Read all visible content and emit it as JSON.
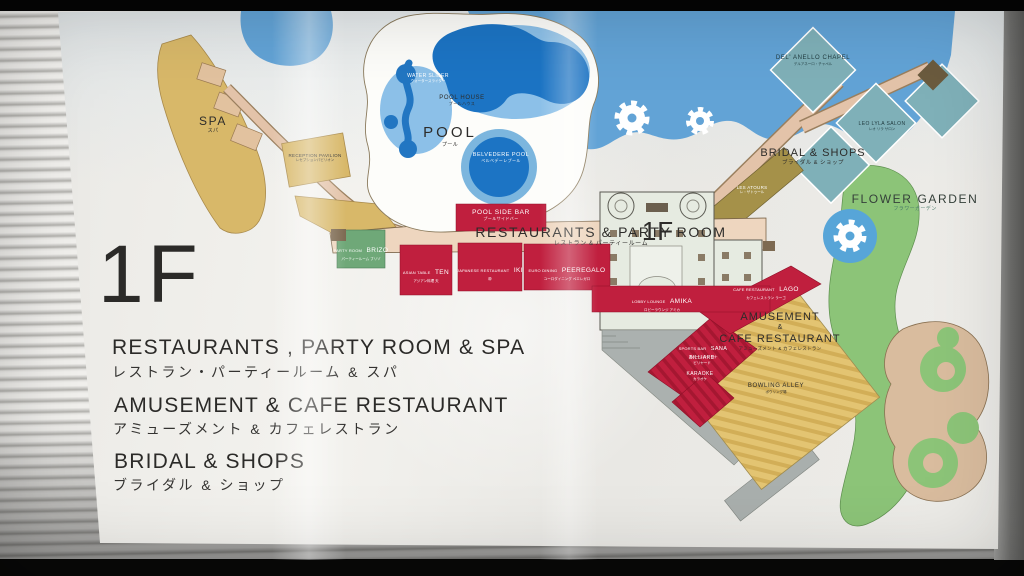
{
  "sign": {
    "legend": {
      "floor": "1F",
      "entries": [
        {
          "en": "RESTAURANTS , PARTY ROOM & SPA",
          "jp": "レストラン・パーティールーム & スパ"
        },
        {
          "en": "AMUSEMENT & CAFE RESTAURANT",
          "jp": "アミューズメント & カフェレストラン"
        },
        {
          "en": "BRIDAL & SHOPS",
          "jp": "ブライダル & ショップ"
        }
      ]
    },
    "map": {
      "building_floor": "1F",
      "areas": {
        "spa": {
          "en": "SPA",
          "jp": "スパ"
        },
        "reception": {
          "en": "RECEPTION PAVILION",
          "jp": "レセプションパビリオン"
        },
        "water_slider": {
          "en": "WATER SLIDER",
          "jp": "ウォータースライダー"
        },
        "pool_house": {
          "en": "POOL HOUSE",
          "jp": "プールハウス"
        },
        "pool": {
          "en": "POOL",
          "jp": "プール"
        },
        "belvedere": {
          "en": "BELVEDERE POOL",
          "jp": "ベルベデーレプール"
        },
        "pool_side_bar": {
          "en": "POOL SIDE BAR",
          "jp": "プールサイドバー"
        },
        "restaurants_band": {
          "en": "RESTAURANTS & PARTY ROOM",
          "jp": "レストラン & パーティールーム"
        },
        "brizo": {
          "pre": "PARTY ROOM",
          "name": "BRIZO",
          "jp": "パーティールーム ブリゾ"
        },
        "ten": {
          "pre": "ASIAN TABLE",
          "name": "TEN",
          "jp": "アジアン料理 天"
        },
        "iki": {
          "pre": "JAPANESE RESTAURANT",
          "name": "IKI",
          "jp": "粋"
        },
        "peeregalo": {
          "pre": "EURO DINING",
          "name": "PEEREGALO",
          "jp": "ユーロダイニング ペエレガロ"
        },
        "amika": {
          "pre": "LOBBY LOUNGE",
          "name": "AMIKA",
          "jp": "ロビーラウンジ アミカ"
        },
        "lago": {
          "pre": "CAFE RESTAURANT",
          "name": "LAGO",
          "jp": "カフェレストラン ラーゴ"
        },
        "amusement": {
          "line1": "AMUSEMENT",
          "amp": "&",
          "line2": "CAFE RESTAURANT",
          "jp": "アミューズメント & カフェレストラン"
        },
        "sana": {
          "pre": "SPORTS BAR",
          "name": "SANA",
          "jp": "スポーツバー サナ"
        },
        "billiard": {
          "en": "BILLIARD",
          "jp": "ビリヤード"
        },
        "karaoke": {
          "en": "KARAOKE",
          "jp": "カラオケ"
        },
        "bowling": {
          "en": "BOWLING ALLEY",
          "jp": "ボウリング場"
        },
        "chapel": {
          "en": "DEL' ANELLO CHAPEL",
          "jp": "デルアネーロ・チャペル"
        },
        "leo_salon": {
          "en": "LEO LYLA SALON",
          "jp": "レオ リラ サロン"
        },
        "les_atours": {
          "en": "LES ATOURS",
          "jp": "レ・ザトゥール"
        },
        "bridal_shops": {
          "en": "BRIDAL & SHOPS",
          "jp": "ブライダル & ショップ"
        },
        "flower_garden": {
          "en": "FLOWER GARDEN",
          "jp": "フラワーガーデン"
        }
      }
    },
    "colors": {
      "water": "#62a3d6",
      "pool": "#1c74c4",
      "red": "#c01f3e",
      "gold": "#d8b869",
      "garden_green": "#8cc478",
      "teal": "#7fb0b8",
      "band_tan": "#eed6bf",
      "brizo_green": "#6fa878",
      "sign_bg": "#edece8"
    }
  }
}
